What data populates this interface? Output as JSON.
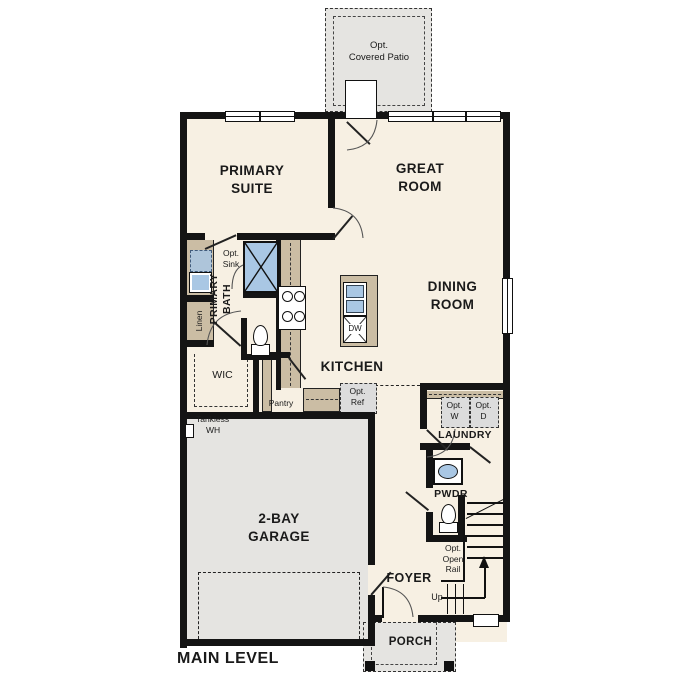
{
  "plan": {
    "title": "MAIN LEVEL",
    "labels": {
      "patio_l1": "Opt.",
      "patio_l2": "Covered Patio",
      "primary_suite_l1": "PRIMARY",
      "primary_suite_l2": "SUITE",
      "great_room_l1": "GREAT",
      "great_room_l2": "ROOM",
      "opt_sink_l1": "Opt.",
      "opt_sink_l2": "Sink",
      "linen": "Linen",
      "primary_bath_l1": "PRIMARY",
      "primary_bath_l2": "BATH",
      "wic": "WIC",
      "pantry": "Pantry",
      "kitchen": "KITCHEN",
      "dw": "DW",
      "dining_l1": "DINING",
      "dining_l2": "ROOM",
      "opt_ref_l1": "Opt.",
      "opt_ref_l2": "Ref",
      "opt_w_l1": "Opt.",
      "opt_w_l2": "W",
      "opt_d_l1": "Opt.",
      "opt_d_l2": "D",
      "laundry": "LAUNDRY",
      "pwdr": "PWDR",
      "opt_rail_l1": "Opt.",
      "opt_rail_l2": "Open",
      "opt_rail_l3": "Rail",
      "up": "Up",
      "foyer": "FOYER",
      "garage_l1": "2-BAY",
      "garage_l2": "GARAGE",
      "tankless_l1": "Tankless",
      "tankless_l2": "WH",
      "porch": "PORCH"
    },
    "colors": {
      "room_fill": "#f7f0e3",
      "garage_fill": "#e5e4e1",
      "counter_fill": "#cbbda4",
      "fixture_blue": "#a9c7e4",
      "wall": "#141414",
      "opt_fill": "#dcdcdc"
    }
  }
}
